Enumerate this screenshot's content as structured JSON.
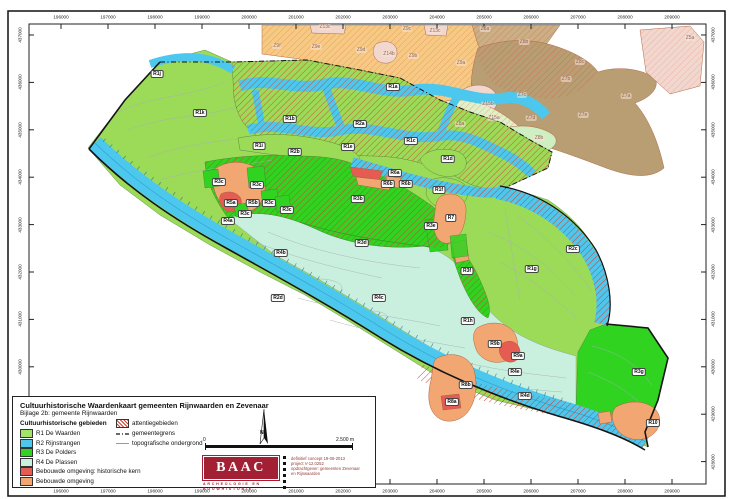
{
  "palette": {
    "r1": "#9BDB58",
    "r2": "#4CC8EE",
    "r3": "#2FD320",
    "r4": "#C9F0DF",
    "sal": "#F2A773",
    "red": "#E45C52",
    "zorange": "#F7C87D",
    "zbrown": "#B5996B",
    "ztan": "#C9AB7F",
    "zpink": "#F2D5CC",
    "z8a": "#DFF0C5",
    "z8b": "#CDEFC0",
    "hatch": "#D0402C",
    "baac": "#A31F34"
  },
  "legend": {
    "title": "Cultuurhistorische Waardenkaart gemeenten Rijnwaarden en Zevenaar",
    "subtitle": "Bijlage 2b: gemeente Rijnwaarden",
    "areas_header": "Cultuurhistorische gebieden",
    "areas": [
      {
        "label": "R1 De Waarden",
        "color": "#A3E468"
      },
      {
        "label": "R2 Rijnstrangen",
        "color": "#4CC8EE"
      },
      {
        "label": "R3 De Polders",
        "color": "#2FD320"
      },
      {
        "label": "R4 De Plassen",
        "color": "#C9F0DF"
      },
      {
        "label": "Bebouwde omgeving: historische kern",
        "color": "#E45C52"
      },
      {
        "label": "Bebouwde omgeving",
        "color": "#F2A773"
      }
    ],
    "symbols": [
      {
        "label": "attentiegebieden",
        "symbol": "hatch"
      },
      {
        "label": "gemeentegrens",
        "symbol": "dashdot"
      },
      {
        "label": "topografische ondergrond",
        "symbol": "line"
      }
    ]
  },
  "scale": {
    "zero": "0",
    "max": "2.500 m",
    "north": "N"
  },
  "logo": {
    "name": "BAAC",
    "sub1": "ARCHEOLOGIE EN",
    "sub2": "BOUWHISTORIE"
  },
  "credits": {
    "lines": [
      "definitief concept 19-06-2013",
      "project V-12.0252",
      "opdrachtgever: gemeenten Zevenaar",
      "en Rijnwaarden"
    ]
  },
  "axes": {
    "x_ticks": [
      "196000",
      "197000",
      "198000",
      "199000",
      "200000",
      "201000",
      "202000",
      "203000",
      "204000",
      "205000",
      "206000",
      "207000",
      "208000",
      "209000"
    ],
    "y_ticks": [
      "437000",
      "436000",
      "435000",
      "434000",
      "433000",
      "432000",
      "431000",
      "430000",
      "429000",
      "428000"
    ],
    "x_start": 61,
    "x_step": 47.0,
    "y_start": 35,
    "y_step": 47.4
  },
  "map": {
    "labels": [
      {
        "t": "R1j",
        "x": 157,
        "y": 74,
        "k": "r"
      },
      {
        "t": "R1k",
        "x": 200,
        "y": 113,
        "k": "r"
      },
      {
        "t": "R1b",
        "x": 290,
        "y": 119,
        "k": "r"
      },
      {
        "t": "R2a",
        "x": 360,
        "y": 124,
        "k": "r"
      },
      {
        "t": "R1a",
        "x": 393,
        "y": 87,
        "k": "r"
      },
      {
        "t": "R1i",
        "x": 259,
        "y": 146,
        "k": "r"
      },
      {
        "t": "R2b",
        "x": 295,
        "y": 152,
        "k": "r"
      },
      {
        "t": "R1e",
        "x": 348,
        "y": 147,
        "k": "r"
      },
      {
        "t": "R1c",
        "x": 411,
        "y": 141,
        "k": "r"
      },
      {
        "t": "R1d",
        "x": 448,
        "y": 159,
        "k": "r"
      },
      {
        "t": "R6a",
        "x": 395,
        "y": 173,
        "k": "r"
      },
      {
        "t": "R6b",
        "x": 388,
        "y": 184,
        "k": "r"
      },
      {
        "t": "R6b",
        "x": 406,
        "y": 184,
        "k": "r"
      },
      {
        "t": "R1f",
        "x": 439,
        "y": 190,
        "k": "r"
      },
      {
        "t": "R3b",
        "x": 358,
        "y": 199,
        "k": "r"
      },
      {
        "t": "R3c",
        "x": 219,
        "y": 182,
        "k": "r"
      },
      {
        "t": "R3c",
        "x": 257,
        "y": 185,
        "k": "r"
      },
      {
        "t": "R5a",
        "x": 231,
        "y": 203,
        "k": "r"
      },
      {
        "t": "R5b",
        "x": 253,
        "y": 203,
        "k": "r"
      },
      {
        "t": "R3c",
        "x": 269,
        "y": 203,
        "k": "r"
      },
      {
        "t": "R3c",
        "x": 287,
        "y": 210,
        "k": "r"
      },
      {
        "t": "R3c",
        "x": 245,
        "y": 214,
        "k": "r"
      },
      {
        "t": "R4a",
        "x": 228,
        "y": 221,
        "k": "r"
      },
      {
        "t": "R3d",
        "x": 362,
        "y": 243,
        "k": "r"
      },
      {
        "t": "R3e",
        "x": 431,
        "y": 226,
        "k": "r"
      },
      {
        "t": "R7",
        "x": 451,
        "y": 218,
        "k": "r"
      },
      {
        "t": "R3f",
        "x": 467,
        "y": 271,
        "k": "r"
      },
      {
        "t": "R2c",
        "x": 573,
        "y": 249,
        "k": "r"
      },
      {
        "t": "R1g",
        "x": 532,
        "y": 269,
        "k": "r"
      },
      {
        "t": "R4b",
        "x": 281,
        "y": 253,
        "k": "r"
      },
      {
        "t": "R2d",
        "x": 278,
        "y": 298,
        "k": "r"
      },
      {
        "t": "R4c",
        "x": 379,
        "y": 298,
        "k": "r"
      },
      {
        "t": "R1h",
        "x": 468,
        "y": 321,
        "k": "r"
      },
      {
        "t": "R9b",
        "x": 495,
        "y": 344,
        "k": "r"
      },
      {
        "t": "R9a",
        "x": 518,
        "y": 356,
        "k": "r"
      },
      {
        "t": "R4e",
        "x": 515,
        "y": 372,
        "k": "r"
      },
      {
        "t": "R4d",
        "x": 525,
        "y": 396,
        "k": "r"
      },
      {
        "t": "R8b",
        "x": 466,
        "y": 385,
        "k": "r"
      },
      {
        "t": "R8a",
        "x": 452,
        "y": 402,
        "k": "r"
      },
      {
        "t": "R3g",
        "x": 639,
        "y": 372,
        "k": "r"
      },
      {
        "t": "R10",
        "x": 653,
        "y": 423,
        "k": "r"
      },
      {
        "t": "Z13c",
        "x": 325,
        "y": 27,
        "k": "z"
      },
      {
        "t": "Z9c",
        "x": 407,
        "y": 29,
        "k": "z"
      },
      {
        "t": "Z13c",
        "x": 435,
        "y": 31,
        "k": "z"
      },
      {
        "t": "Z5a",
        "x": 690,
        "y": 38,
        "k": "z"
      },
      {
        "t": "Z9f",
        "x": 277,
        "y": 46,
        "k": "z"
      },
      {
        "t": "Z9e",
        "x": 316,
        "y": 47,
        "k": "z"
      },
      {
        "t": "Z9d",
        "x": 361,
        "y": 50,
        "k": "z"
      },
      {
        "t": "Z14b",
        "x": 389,
        "y": 54,
        "k": "z"
      },
      {
        "t": "Z9b",
        "x": 413,
        "y": 56,
        "k": "z"
      },
      {
        "t": "Z8a",
        "x": 485,
        "y": 29,
        "k": "z"
      },
      {
        "t": "Z8b",
        "x": 524,
        "y": 42,
        "k": "z"
      },
      {
        "t": "Z8c",
        "x": 580,
        "y": 62,
        "k": "z"
      },
      {
        "t": "Z9a",
        "x": 461,
        "y": 63,
        "k": "z"
      },
      {
        "t": "Z7b",
        "x": 566,
        "y": 79,
        "k": "z"
      },
      {
        "t": "Z7c",
        "x": 522,
        "y": 95,
        "k": "z"
      },
      {
        "t": "Z7a",
        "x": 626,
        "y": 96,
        "k": "z"
      },
      {
        "t": "Z15b",
        "x": 488,
        "y": 104,
        "k": "z"
      },
      {
        "t": "Z7e",
        "x": 583,
        "y": 115,
        "k": "z"
      },
      {
        "t": "Z15a",
        "x": 494,
        "y": 118,
        "k": "z"
      },
      {
        "t": "Z7d",
        "x": 531,
        "y": 118,
        "k": "z"
      },
      {
        "t": "Z8a",
        "x": 460,
        "y": 124,
        "k": "z"
      },
      {
        "t": "Z8b",
        "x": 539,
        "y": 138,
        "k": "z"
      }
    ]
  }
}
